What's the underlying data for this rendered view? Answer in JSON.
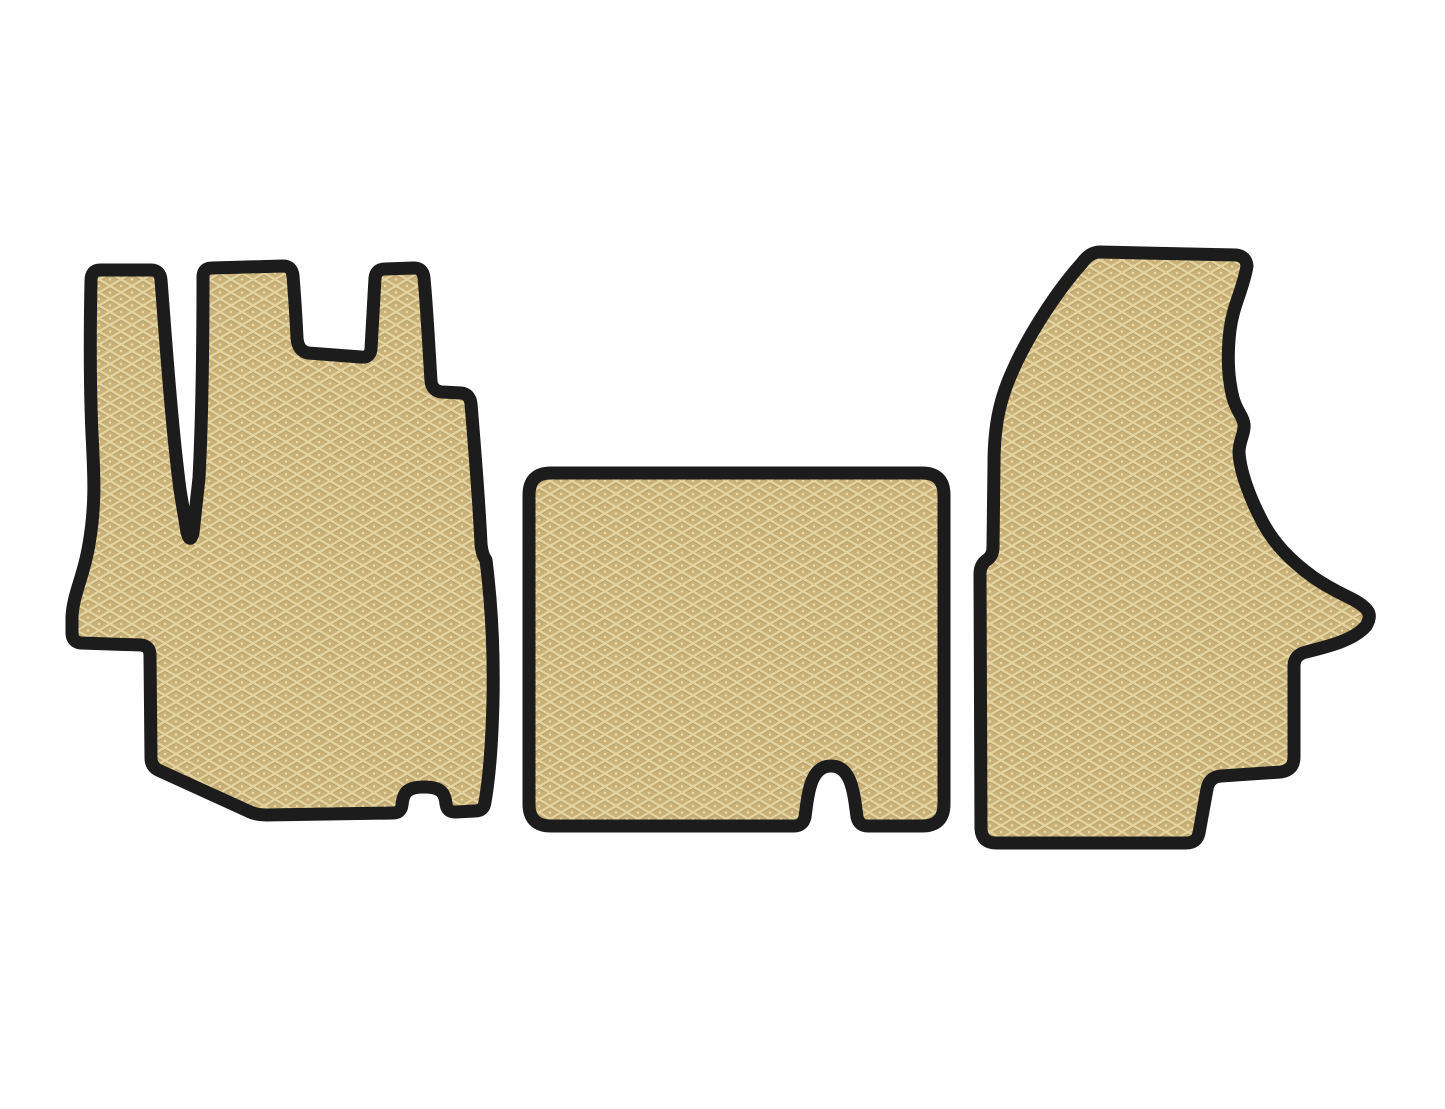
{
  "scene": {
    "type": "product-photo",
    "subject": "Set of three EVA foam car floor mats (front row: driver mat, engine-tunnel mat, passenger mat)",
    "background_color": "#ffffff"
  },
  "canvas": {
    "width": 1445,
    "height": 1109
  },
  "colors": {
    "background": "#ffffff",
    "mat-border": "#1c1c1c",
    "mat-base": "#c9b177",
    "mat-hatch-light": "#e6d8a6",
    "mat-hatch-shadow": "#a8915c",
    "mat-dot": "#f0e4ba"
  },
  "texture": {
    "name": "rhombus-crosshatch",
    "tile_width": 22,
    "tile_height": 13,
    "border_thickness": 13
  },
  "mats": [
    {
      "id": "driver-floor-mat",
      "description": "Left mat with two top tabs, narrow V slot, stepped right side, bottom rectangular notch",
      "path": "M 100,270 L 151,270 Q 160,270 161,280 C 165,330 171,420 180,490 L 187,532 Q 190,544 193,533 L 199,478 C 202,420 203,340 203,277 Q 203,268 212,268 L 283,266 Q 292,266 293,276 C 295,300 296,318 297,338 Q 298,351 308,353 L 361,357 Q 370,358 371,349 L 375,278 Q 376,269 385,269 L 414,268 Q 423,268 424,278 C 427,310 429,350 431,381 Q 432,391 442,392 L 461,393 Q 470,394 471,404 C 474,440 479,500 481,544 Q 482,555 486,560 C 491,600 494,650 493,700 C 492,744 489,779 485,802 Q 484,811 475,811 L 455,812 Q 447,812 446,804 C 445,792 440,787 424,787 C 408,787 403,792 402,805 Q 401,813 393,813 L 266,815 Q 256,815 248,811 L 158,770 Q 151,766 151,758 L 150,655 Q 150,646 141,645 L 81,643 Q 72,642 72,633 L 72,617 C 73,594 84,576 89,544 C 96,504 94,474 92,434 C 90,390 90,330 91,281 Q 91,270 100,270 Z"
    },
    {
      "id": "center-tunnel-floor-mat",
      "description": "Middle rounded-rectangle mat with arched notch in bottom edge near right side",
      "path": "M 551,473 L 922,473 Q 944,473 944,495 L 944,804 Q 944,826 922,826 L 868,826 Q 859,826 857,817 C 854,795 852,766 831,766 C 810,766 808,795 805,817 Q 803,826 794,826 L 551,826 Q 529,826 529,804 L 529,495 Q 529,473 551,473 Z"
    },
    {
      "id": "passenger-floor-mat",
      "description": "Right mat with slanted top-left edge, wavy right side, pointed right foot and stepped bottom-right notch",
      "path": "M 1100,252 L 1236,255 Q 1246,256 1247,266 C 1243,290 1233,305 1230,330 C 1227,355 1228,378 1233,398 C 1237,412 1243,416 1244,424 C 1245,433 1239,441 1239,452 C 1240,472 1250,498 1262,521 C 1274,544 1291,561 1313,577 C 1340,596 1357,598 1367,610 Q 1372,616 1366,626 C 1354,640 1330,646 1306,652 Q 1294,655 1294,666 L 1294,757 Q 1294,770 1281,772 L 1221,776 Q 1209,777 1207,789 L 1199,833 Q 1197,843 1186,843 L 996,843 Q 982,843 981,829 L 980,574 Q 980,564 988,559 Q 993,555 993,547 L 994,464 C 994,420 1002,394 1013,370 C 1028,336 1056,292 1082,263 Q 1090,252 1100,252 Z"
    }
  ]
}
